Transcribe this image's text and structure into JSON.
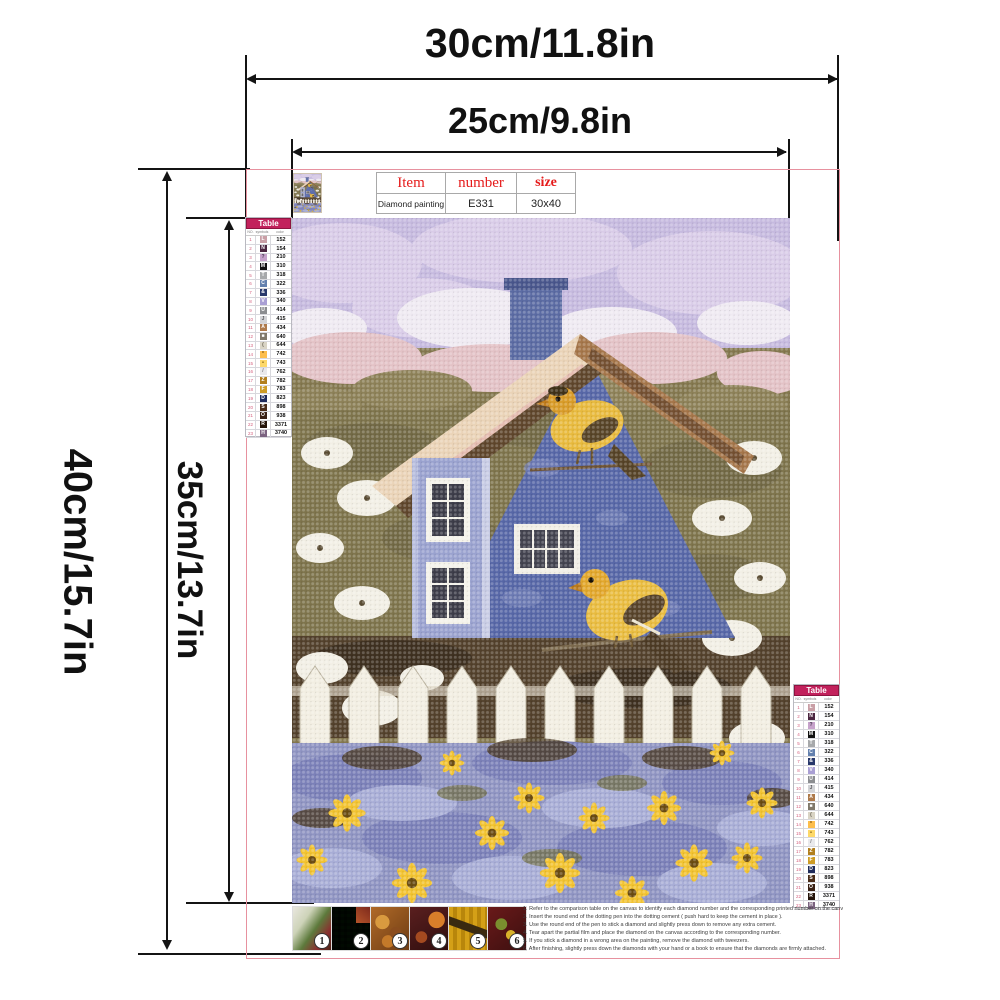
{
  "dimensions": {
    "outer_width": "30cm/11.8in",
    "inner_width": "25cm/9.8in",
    "outer_height": "40cm/15.7in",
    "inner_height": "35cm/13.7in"
  },
  "info": {
    "headers": [
      "Item",
      "number",
      "size"
    ],
    "row": [
      "Diamond painting",
      "E331",
      "30x40"
    ]
  },
  "color_table": {
    "title": "Table",
    "columns": [
      "NO.",
      "symbols",
      "color"
    ],
    "header_bg": "#C2215C",
    "rows": [
      {
        "no": "1",
        "sym": "L",
        "code": "152",
        "bg": "#C99FA6",
        "fg": "#FFFFFF"
      },
      {
        "no": "2",
        "sym": "N",
        "code": "154",
        "bg": "#4B2640",
        "fg": "#FFFFFF"
      },
      {
        "no": "3",
        "sym": "?",
        "code": "210",
        "bg": "#C6A2CB",
        "fg": "#4A3B52"
      },
      {
        "no": "4",
        "sym": "M",
        "code": "310",
        "bg": "#121212",
        "fg": "#FFFFFF"
      },
      {
        "no": "5",
        "sym": "T",
        "code": "318",
        "bg": "#A7A9AB",
        "fg": "#FFFFFF"
      },
      {
        "no": "6",
        "sym": "C",
        "code": "322",
        "bg": "#6380AE",
        "fg": "#FFFFFF"
      },
      {
        "no": "7",
        "sym": "&",
        "code": "336",
        "bg": "#28386B",
        "fg": "#FFFFFF"
      },
      {
        "no": "8",
        "sym": "V",
        "code": "340",
        "bg": "#A99FD4",
        "fg": "#FFFFFF"
      },
      {
        "no": "9",
        "sym": "U",
        "code": "414",
        "bg": "#8B8D90",
        "fg": "#FFFFFF"
      },
      {
        "no": "10",
        "sym": "J",
        "code": "415",
        "bg": "#D2D3D6",
        "fg": "#5A5A5E"
      },
      {
        "no": "11",
        "sym": "A",
        "code": "434",
        "bg": "#AE7A4B",
        "fg": "#FFFFFF"
      },
      {
        "no": "12",
        "sym": "■",
        "code": "640",
        "bg": "#80796B",
        "fg": "#FFFFFF"
      },
      {
        "no": "13",
        "sym": "(",
        "code": "644",
        "bg": "#D9D4C5",
        "fg": "#6B6657"
      },
      {
        "no": "14",
        "sym": "*",
        "code": "742",
        "bg": "#FDBE4C",
        "fg": "#7A5210"
      },
      {
        "no": "15",
        "sym": "•",
        "code": "743",
        "bg": "#FDD868",
        "fg": "#7A5A10"
      },
      {
        "no": "16",
        "sym": "/",
        "code": "762",
        "bg": "#E9E9EC",
        "fg": "#77777C"
      },
      {
        "no": "17",
        "sym": "Z",
        "code": "782",
        "bg": "#B27F1E",
        "fg": "#FFFFFF"
      },
      {
        "no": "18",
        "sym": "F",
        "code": "783",
        "bg": "#CE9C25",
        "fg": "#FFFFFF"
      },
      {
        "no": "19",
        "sym": "D",
        "code": "823",
        "bg": "#1F2B5B",
        "fg": "#FFFFFF"
      },
      {
        "no": "20",
        "sym": "S",
        "code": "898",
        "bg": "#4A2C18",
        "fg": "#FFFFFF"
      },
      {
        "no": "21",
        "sym": "O",
        "code": "938",
        "bg": "#3A2114",
        "fg": "#FFFFFF"
      },
      {
        "no": "22",
        "sym": "R",
        "code": "3371",
        "bg": "#241309",
        "fg": "#FFFFFF"
      },
      {
        "no": "23",
        "sym": "H",
        "code": "3740",
        "bg": "#7B6380",
        "fg": "#FFFFFF"
      }
    ]
  },
  "steps": {
    "numbers": [
      "1",
      "2",
      "3",
      "4",
      "5",
      "6"
    ]
  },
  "instructions": [
    "1. Refer to the comparison table on the canvas to identify each diamond number and the corresponding printed number on the canvas.",
    "2. Insert the round end of the dotting pen into the dotting cement ( push hard to keep the cement in place ).",
    "3. Use the round end of the pen to stick a diamond and slightly press down to remove any extra cement.",
    "4. Tear apart the partial film and place the diamond on the canvas according to the corresponding number.",
    "5. If you stick a diamond in a wrong area on the painting, remove the diamond with tweezers.",
    "6. After finishing, slightly press down the diamonds with your hand or a book to ensure that the diamonds are firmly attached."
  ],
  "colors": {
    "outline_pink": "#E7919F",
    "header_red": "#E51A1A",
    "table_header_bg": "#C2215C",
    "dimension_line": "#141414"
  }
}
